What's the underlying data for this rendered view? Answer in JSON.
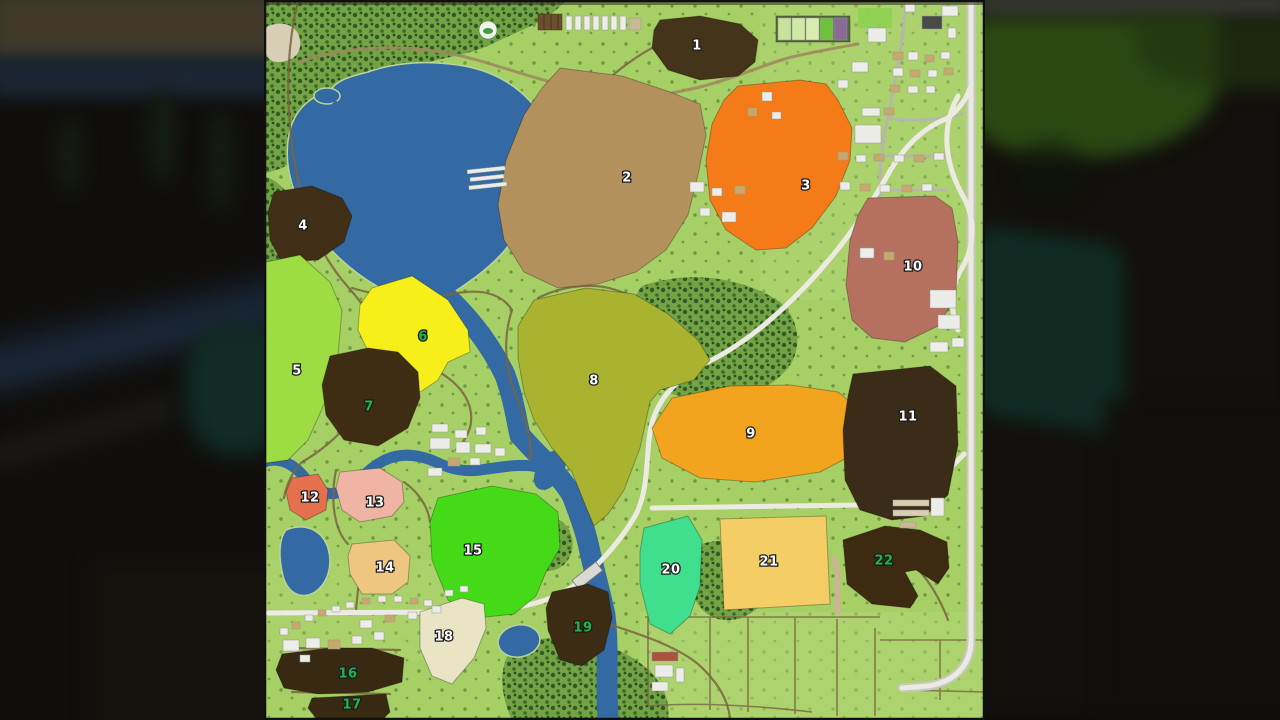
{
  "map": {
    "title": "field-overview-map",
    "label_outline_color": "#1c1c1c",
    "terrain_colors": {
      "grass": "#a6cf66",
      "forest": "#73a344",
      "water": "#336aa4",
      "dirt_road": "#7a6440",
      "paved_road": "#eceae2",
      "field_border": "rgba(0,0,0,0.28)"
    },
    "greenhouse": {
      "frame_color": "#55683f",
      "plot_colors": [
        "#c5e39a",
        "#cfe8a6",
        "#d8edaf",
        "#6fc13c",
        "#8a6b96"
      ]
    },
    "fields": [
      {
        "number": "1",
        "color": "#43341a",
        "label_color": "#ffffff",
        "label_x": 697,
        "label_y": 46,
        "points": "660,20 700,16 740,24 758,40 755,62 738,76 700,80 668,70 652,48 654,30"
      },
      {
        "number": "2",
        "color": "#b3915c",
        "label_color": "#ffffff",
        "label_x": 627,
        "label_y": 178,
        "points": "560,68 622,76 670,92 700,104 706,135 698,175 688,215 666,250 636,272 598,284 558,288 524,272 504,240 498,205 506,160 524,115 542,88"
      },
      {
        "number": "3",
        "color": "#f57a18",
        "label_color": "#ffffff",
        "label_x": 806,
        "label_y": 186,
        "points": "738,86 800,80 826,84 838,100 852,128 850,160 836,196 812,228 786,248 756,250 726,230 710,200 706,160 712,124 724,100"
      },
      {
        "number": "4",
        "color": "#402f16",
        "label_color": "#ffffff",
        "label_x": 303,
        "label_y": 226,
        "points": "274,192 312,186 342,198 352,216 344,242 318,260 282,262 270,240 268,212"
      },
      {
        "number": "5",
        "color": "#9edc43",
        "label_color": "#ffffff",
        "label_x": 297,
        "label_y": 371,
        "points": "266,262 300,255 330,282 342,310 338,355 326,400 308,440 288,460 266,463"
      },
      {
        "number": "6",
        "color": "#f6ef1a",
        "label_color": "#23b14d",
        "label_x": 423,
        "label_y": 337,
        "points": "372,288 412,276 448,300 468,330 470,352 448,362 438,380 420,392 398,388 372,360 358,330 360,305"
      },
      {
        "number": "7",
        "color": "#3f2d13",
        "label_color": "#23b14d",
        "label_x": 369,
        "label_y": 407,
        "points": "330,356 368,348 398,352 418,372 420,398 408,428 378,446 344,440 326,415 322,385"
      },
      {
        "number": "8",
        "color": "#a9b330",
        "label_color": "#ffffff",
        "label_x": 594,
        "label_y": 381,
        "points": "534,300 586,288 634,294 668,314 698,340 710,360 694,380 660,390 650,402 640,448 624,490 608,514 594,526 584,502 572,472 552,448 534,420 524,392 518,358 518,326"
      },
      {
        "number": "9",
        "color": "#f2a41f",
        "label_color": "#ffffff",
        "label_x": 751,
        "label_y": 434,
        "points": "672,398 730,386 790,385 838,392 866,415 858,452 820,472 755,482 700,478 662,458 652,428"
      },
      {
        "number": "10",
        "color": "#b5705f",
        "label_color": "#ffffff",
        "label_x": 913,
        "label_y": 267,
        "points": "868,198 935,196 952,208 958,242 956,296 938,326 905,342 872,338 852,320 846,285 850,240 858,215"
      },
      {
        "number": "11",
        "color": "#3a2c16",
        "label_color": "#ffffff",
        "label_x": 908,
        "label_y": 417,
        "points": "853,374 930,366 956,386 958,445 948,495 925,516 892,520 860,510 845,480 843,430 848,396"
      },
      {
        "number": "12",
        "color": "#e4704d",
        "label_color": "#ffffff",
        "label_x": 310,
        "label_y": 498,
        "points": "292,478 318,474 328,490 326,510 306,520 290,510 286,492"
      },
      {
        "number": "13",
        "color": "#f0b4a4",
        "label_color": "#ffffff",
        "label_x": 375,
        "label_y": 503,
        "points": "340,472 380,468 402,482 404,502 392,516 360,522 342,510 336,488"
      },
      {
        "number": "14",
        "color": "#eec67f",
        "label_color": "#ffffff",
        "label_x": 385,
        "label_y": 568,
        "points": "352,544 394,540 410,556 408,582 392,594 362,594 350,574 348,556"
      },
      {
        "number": "15",
        "color": "#45da17",
        "label_color": "#ffffff",
        "label_x": 473,
        "label_y": 551,
        "points": "438,498 492,486 536,494 558,512 560,548 546,572 536,596 514,614 478,618 448,600 432,560 430,522"
      },
      {
        "number": "16",
        "color": "#382a12",
        "label_color": "#23b14d",
        "label_x": 348,
        "label_y": 674,
        "points": "282,654 330,648 372,648 404,658 402,682 368,692 318,694 284,688 276,670"
      },
      {
        "number": "17",
        "color": "#382a12",
        "label_color": "#23b14d",
        "label_x": 352,
        "label_y": 705,
        "points": "312,698 386,694 390,712 384,718 316,718 308,708"
      },
      {
        "number": "18",
        "color": "#e9e5c4",
        "label_color": "#ffffff",
        "label_x": 444,
        "label_y": 637,
        "points": "420,612 462,598 484,604 486,628 474,658 452,684 432,676 420,648"
      },
      {
        "number": "19",
        "color": "#3b2c13",
        "label_color": "#23b14d",
        "label_x": 583,
        "label_y": 628,
        "points": "552,592 588,584 608,592 612,618 604,650 582,666 560,660 548,630 546,608"
      },
      {
        "number": "20",
        "color": "#3fdf8d",
        "label_color": "#ffffff",
        "label_x": 671,
        "label_y": 570,
        "points": "644,528 688,516 702,540 700,586 690,616 670,634 650,624 640,584 640,552"
      },
      {
        "number": "21",
        "color": "#f4cd64",
        "label_color": "#ffffff",
        "label_x": 769,
        "label_y": 562,
        "points": "720,519 826,516 830,604 724,610"
      },
      {
        "number": "22",
        "color": "#3c2b10",
        "label_color": "#23b14d",
        "label_x": 884,
        "label_y": 561,
        "points": "843,540 885,526 920,530 947,542 949,568 938,584 916,570 905,572 918,596 910,608 872,604 847,584"
      }
    ]
  }
}
